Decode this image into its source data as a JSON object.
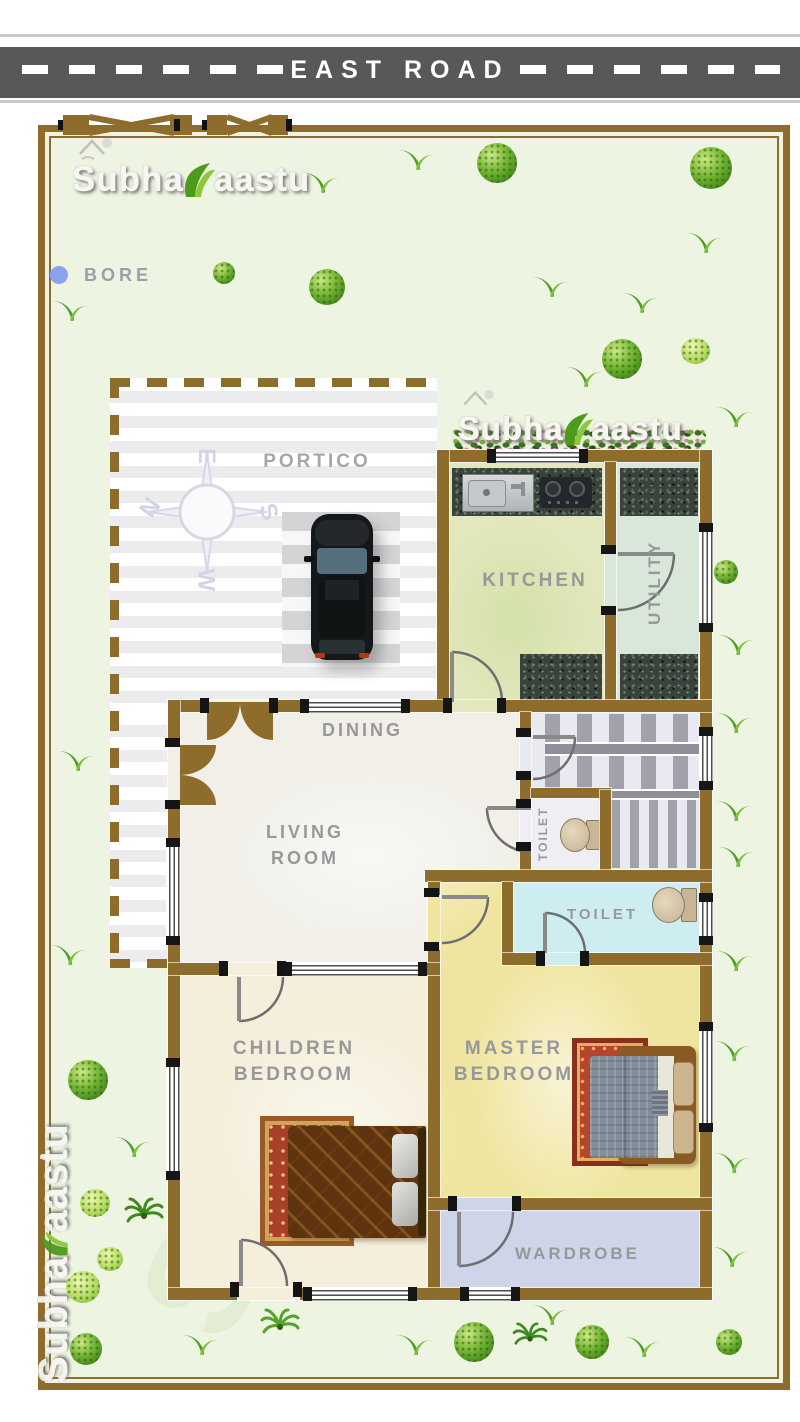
{
  "road": {
    "label": "EAST ROAD"
  },
  "site": {
    "bore_label": "BORE"
  },
  "brand": {
    "part1": "Subha",
    "part2": "aastu"
  },
  "compass": {
    "east": "E",
    "south": "S",
    "west": "W",
    "north": "N"
  },
  "rooms": {
    "portico": "PORTICO",
    "kitchen": "KITCHEN",
    "utility": "UTILITY",
    "dining": "DINING",
    "living_line1": "LIVING",
    "living_line2": "ROOM",
    "toilet_attached": "TOILET",
    "toilet_common": "TOILET",
    "children_line1": "CHILDREN",
    "children_line2": "BEDROOM",
    "master_line1": "MASTER",
    "master_line2": "BEDROOM",
    "wardrobe": "WARDROBE"
  },
  "colors": {
    "wall_brown": "#8d6c2c",
    "road_gray": "#58585a",
    "lawn_green": "#edf4e1",
    "kitchen_fill": "#e2e7bd",
    "utility_fill": "#d9e7db",
    "living_fill": "#f1efe8",
    "children_fill": "#f4eeda",
    "master_fill": "#f0e5a0",
    "wardrobe_fill": "#cfd5e9",
    "toilet_fill": "#cdedf1",
    "bore_blue": "#8ba3ee"
  }
}
